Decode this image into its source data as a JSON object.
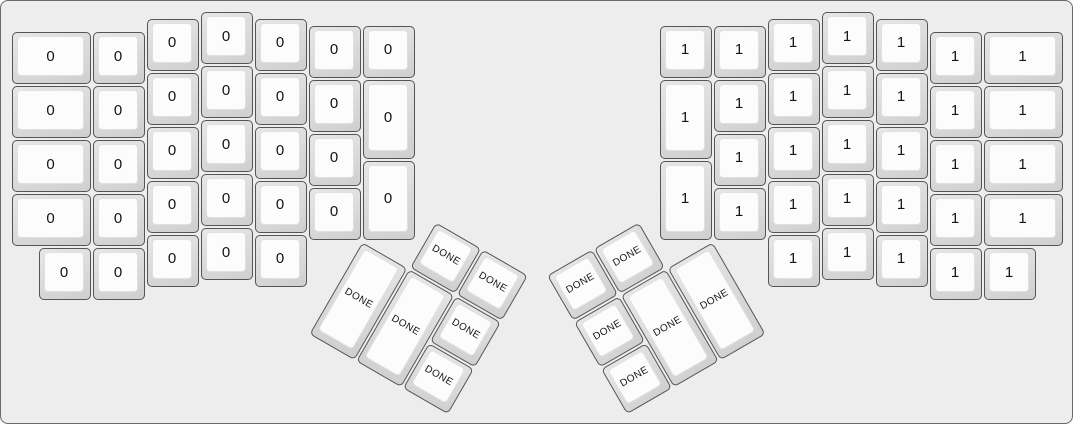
{
  "colors": {
    "background": "#ededed",
    "canvas_border": "#6a6a6a",
    "key_side_light": "#e7e7e7",
    "key_side_dark": "#cfcfcf",
    "key_border": "#555555",
    "key_top": "#fcfcfc",
    "key_top_border": "#e0e0e0",
    "label": "#141414"
  },
  "keyboard": {
    "unit": 54,
    "origin": {
      "x": 10,
      "y": 10
    },
    "groups": [
      {
        "id": "left-main",
        "keys": [
          {
            "x": 0,
            "y": 0.375,
            "w": 1.5,
            "h": 1,
            "label": "0"
          },
          {
            "x": 1.5,
            "y": 0.375,
            "w": 1,
            "h": 1,
            "label": "0"
          },
          {
            "x": 2.5,
            "y": 0.125,
            "w": 1,
            "h": 1,
            "label": "0"
          },
          {
            "x": 3.5,
            "y": 0,
            "w": 1,
            "h": 1,
            "label": "0"
          },
          {
            "x": 4.5,
            "y": 0.125,
            "w": 1,
            "h": 1,
            "label": "0"
          },
          {
            "x": 5.5,
            "y": 0.25,
            "w": 1,
            "h": 1,
            "label": "0"
          },
          {
            "x": 6.5,
            "y": 0.25,
            "w": 1,
            "h": 1,
            "label": "0"
          },
          {
            "x": 0,
            "y": 1.375,
            "w": 1.5,
            "h": 1,
            "label": "0"
          },
          {
            "x": 1.5,
            "y": 1.375,
            "w": 1,
            "h": 1,
            "label": "0"
          },
          {
            "x": 2.5,
            "y": 1.125,
            "w": 1,
            "h": 1,
            "label": "0"
          },
          {
            "x": 3.5,
            "y": 1,
            "w": 1,
            "h": 1,
            "label": "0"
          },
          {
            "x": 4.5,
            "y": 1.125,
            "w": 1,
            "h": 1,
            "label": "0"
          },
          {
            "x": 5.5,
            "y": 1.25,
            "w": 1,
            "h": 1,
            "label": "0"
          },
          {
            "x": 6.5,
            "y": 1.25,
            "w": 1,
            "h": 1.5,
            "label": "0"
          },
          {
            "x": 0,
            "y": 2.375,
            "w": 1.5,
            "h": 1,
            "label": "0"
          },
          {
            "x": 1.5,
            "y": 2.375,
            "w": 1,
            "h": 1,
            "label": "0"
          },
          {
            "x": 2.5,
            "y": 2.125,
            "w": 1,
            "h": 1,
            "label": "0"
          },
          {
            "x": 3.5,
            "y": 2,
            "w": 1,
            "h": 1,
            "label": "0"
          },
          {
            "x": 4.5,
            "y": 2.125,
            "w": 1,
            "h": 1,
            "label": "0"
          },
          {
            "x": 5.5,
            "y": 2.25,
            "w": 1,
            "h": 1,
            "label": "0"
          },
          {
            "x": 6.5,
            "y": 2.75,
            "w": 1,
            "h": 1.5,
            "label": "0"
          },
          {
            "x": 0,
            "y": 3.375,
            "w": 1.5,
            "h": 1,
            "label": "0"
          },
          {
            "x": 1.5,
            "y": 3.375,
            "w": 1,
            "h": 1,
            "label": "0"
          },
          {
            "x": 2.5,
            "y": 3.125,
            "w": 1,
            "h": 1,
            "label": "0"
          },
          {
            "x": 3.5,
            "y": 3,
            "w": 1,
            "h": 1,
            "label": "0"
          },
          {
            "x": 4.5,
            "y": 3.125,
            "w": 1,
            "h": 1,
            "label": "0"
          },
          {
            "x": 5.5,
            "y": 3.25,
            "w": 1,
            "h": 1,
            "label": "0"
          },
          {
            "x": 0.5,
            "y": 4.375,
            "w": 1,
            "h": 1,
            "label": "0"
          },
          {
            "x": 1.5,
            "y": 4.375,
            "w": 1,
            "h": 1,
            "label": "0"
          },
          {
            "x": 2.5,
            "y": 4.125,
            "w": 1,
            "h": 1,
            "label": "0"
          },
          {
            "x": 3.5,
            "y": 4,
            "w": 1,
            "h": 1,
            "label": "0"
          },
          {
            "x": 4.5,
            "y": 4.125,
            "w": 1,
            "h": 1,
            "label": "0"
          }
        ]
      },
      {
        "id": "right-main",
        "keys": [
          {
            "x": 12,
            "y": 0.25,
            "w": 1,
            "h": 1,
            "label": "1"
          },
          {
            "x": 13,
            "y": 0.25,
            "w": 1,
            "h": 1,
            "label": "1"
          },
          {
            "x": 14,
            "y": 0.125,
            "w": 1,
            "h": 1,
            "label": "1"
          },
          {
            "x": 15,
            "y": 0,
            "w": 1,
            "h": 1,
            "label": "1"
          },
          {
            "x": 16,
            "y": 0.125,
            "w": 1,
            "h": 1,
            "label": "1"
          },
          {
            "x": 17,
            "y": 0.375,
            "w": 1,
            "h": 1,
            "label": "1"
          },
          {
            "x": 18,
            "y": 0.375,
            "w": 1.5,
            "h": 1,
            "label": "1"
          },
          {
            "x": 12,
            "y": 1.25,
            "w": 1,
            "h": 1.5,
            "label": "1"
          },
          {
            "x": 13,
            "y": 1.25,
            "w": 1,
            "h": 1,
            "label": "1"
          },
          {
            "x": 14,
            "y": 1.125,
            "w": 1,
            "h": 1,
            "label": "1"
          },
          {
            "x": 15,
            "y": 1,
            "w": 1,
            "h": 1,
            "label": "1"
          },
          {
            "x": 16,
            "y": 1.125,
            "w": 1,
            "h": 1,
            "label": "1"
          },
          {
            "x": 17,
            "y": 1.375,
            "w": 1,
            "h": 1,
            "label": "1"
          },
          {
            "x": 18,
            "y": 1.375,
            "w": 1.5,
            "h": 1,
            "label": "1"
          },
          {
            "x": 12,
            "y": 2.75,
            "w": 1,
            "h": 1.5,
            "label": "1"
          },
          {
            "x": 13,
            "y": 2.25,
            "w": 1,
            "h": 1,
            "label": "1"
          },
          {
            "x": 14,
            "y": 2.125,
            "w": 1,
            "h": 1,
            "label": "1"
          },
          {
            "x": 15,
            "y": 2,
            "w": 1,
            "h": 1,
            "label": "1"
          },
          {
            "x": 16,
            "y": 2.125,
            "w": 1,
            "h": 1,
            "label": "1"
          },
          {
            "x": 17,
            "y": 2.375,
            "w": 1,
            "h": 1,
            "label": "1"
          },
          {
            "x": 18,
            "y": 2.375,
            "w": 1.5,
            "h": 1,
            "label": "1"
          },
          {
            "x": 13,
            "y": 3.25,
            "w": 1,
            "h": 1,
            "label": "1"
          },
          {
            "x": 14,
            "y": 3.125,
            "w": 1,
            "h": 1,
            "label": "1"
          },
          {
            "x": 15,
            "y": 3,
            "w": 1,
            "h": 1,
            "label": "1"
          },
          {
            "x": 16,
            "y": 3.125,
            "w": 1,
            "h": 1,
            "label": "1"
          },
          {
            "x": 17,
            "y": 3.375,
            "w": 1,
            "h": 1,
            "label": "1"
          },
          {
            "x": 18,
            "y": 3.375,
            "w": 1.5,
            "h": 1,
            "label": "1"
          },
          {
            "x": 14,
            "y": 4.125,
            "w": 1,
            "h": 1,
            "label": "1"
          },
          {
            "x": 15,
            "y": 4,
            "w": 1,
            "h": 1,
            "label": "1"
          },
          {
            "x": 16,
            "y": 4.125,
            "w": 1,
            "h": 1,
            "label": "1"
          },
          {
            "x": 17,
            "y": 4.375,
            "w": 1,
            "h": 1,
            "label": "1"
          },
          {
            "x": 18,
            "y": 4.375,
            "w": 1,
            "h": 1,
            "label": "1"
          }
        ]
      },
      {
        "id": "left-thumb",
        "rotation": 30,
        "rx": 6.5,
        "ry": 4.25,
        "keys": [
          {
            "x": 1,
            "y": -1,
            "w": 1,
            "h": 1,
            "label": "DONE"
          },
          {
            "x": 2,
            "y": -1,
            "w": 1,
            "h": 1,
            "label": "DONE"
          },
          {
            "x": 0,
            "y": 0,
            "w": 1,
            "h": 2,
            "label": "DONE"
          },
          {
            "x": 1,
            "y": 0,
            "w": 1,
            "h": 2,
            "label": "DONE"
          },
          {
            "x": 2,
            "y": 0,
            "w": 1,
            "h": 1,
            "label": "DONE"
          },
          {
            "x": 2,
            "y": 1,
            "w": 1,
            "h": 1,
            "label": "DONE"
          }
        ]
      },
      {
        "id": "right-thumb",
        "rotation": -30,
        "rx": 13,
        "ry": 4.25,
        "keys": [
          {
            "x": -3,
            "y": -1,
            "w": 1,
            "h": 1,
            "label": "DONE"
          },
          {
            "x": -2,
            "y": -1,
            "w": 1,
            "h": 1,
            "label": "DONE"
          },
          {
            "x": -3,
            "y": 0,
            "w": 1,
            "h": 1,
            "label": "DONE"
          },
          {
            "x": -3,
            "y": 1,
            "w": 1,
            "h": 1,
            "label": "DONE"
          },
          {
            "x": -2,
            "y": 0,
            "w": 1,
            "h": 2,
            "label": "DONE"
          },
          {
            "x": -1,
            "y": 0,
            "w": 1,
            "h": 2,
            "label": "DONE"
          }
        ]
      }
    ]
  }
}
